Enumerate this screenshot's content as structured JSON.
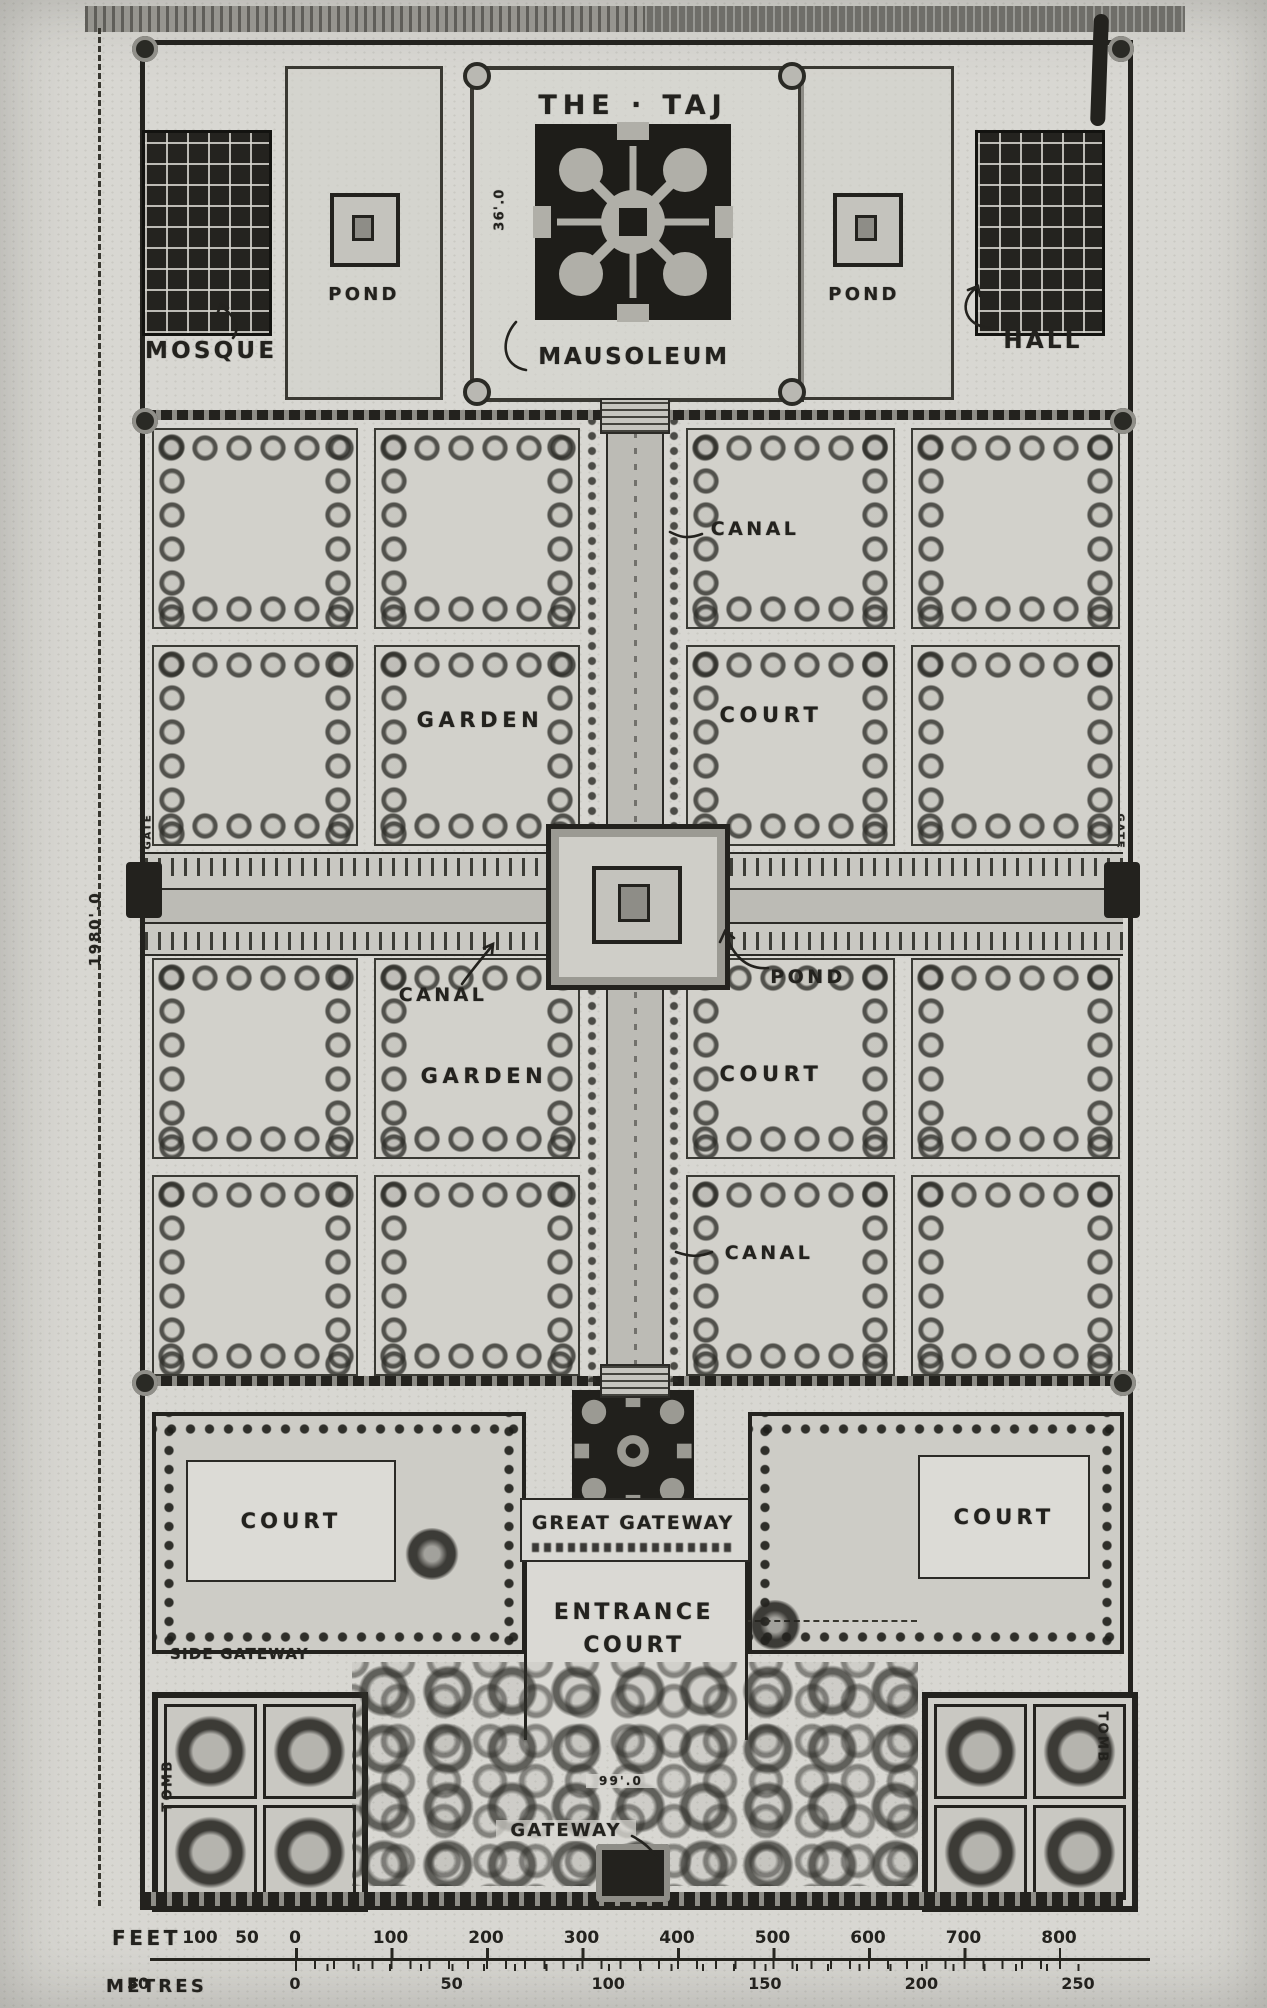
{
  "colors": {
    "paper": "#d8d7d2",
    "ink": "#23221e",
    "water": "#bcbbb5",
    "dark": "#1d1d1a",
    "mid": "#8e8d87"
  },
  "title": {
    "text": "THE · TAJ"
  },
  "terrace": {
    "mosque": "MOSQUE",
    "hall": "HALL",
    "mausoleum": "MAUSOLEUM",
    "pond_left": "POND",
    "pond_right": "POND",
    "platform_width": "36'.0"
  },
  "garden": {
    "canal_north": "CANAL",
    "canal_west": "CANAL",
    "canal_south": "CANAL",
    "pond_center": "POND",
    "garden_upper": "GARDEN",
    "court_upper": "COURT",
    "garden_lower": "GARDEN",
    "court_lower": "COURT",
    "gate_west": "GATE",
    "gate_east": "GATE"
  },
  "forecourt": {
    "great_gateway": "GREAT GATEWAY",
    "entrance_court": "ENTRANCE COURT",
    "court_west": "COURT",
    "court_east": "COURT",
    "side_gateway": "SIDE GATEWAY",
    "tomb_west": "TOMB",
    "tomb_east": "TOMB",
    "south_gateway": "GATEWAY",
    "gateway_width": "99'.0"
  },
  "dimensions": {
    "overall_length": "1980'.0"
  },
  "scale_bar": {
    "feet_label": "FEET",
    "metres_label": "METRES",
    "feet_pre": [
      "100",
      "50"
    ],
    "feet_main": [
      "0",
      "100",
      "200",
      "300",
      "400",
      "500",
      "600",
      "700",
      "800"
    ],
    "metres_pre": [
      "50"
    ],
    "metres_main": [
      "0",
      "50",
      "100",
      "150",
      "200",
      "250"
    ]
  }
}
